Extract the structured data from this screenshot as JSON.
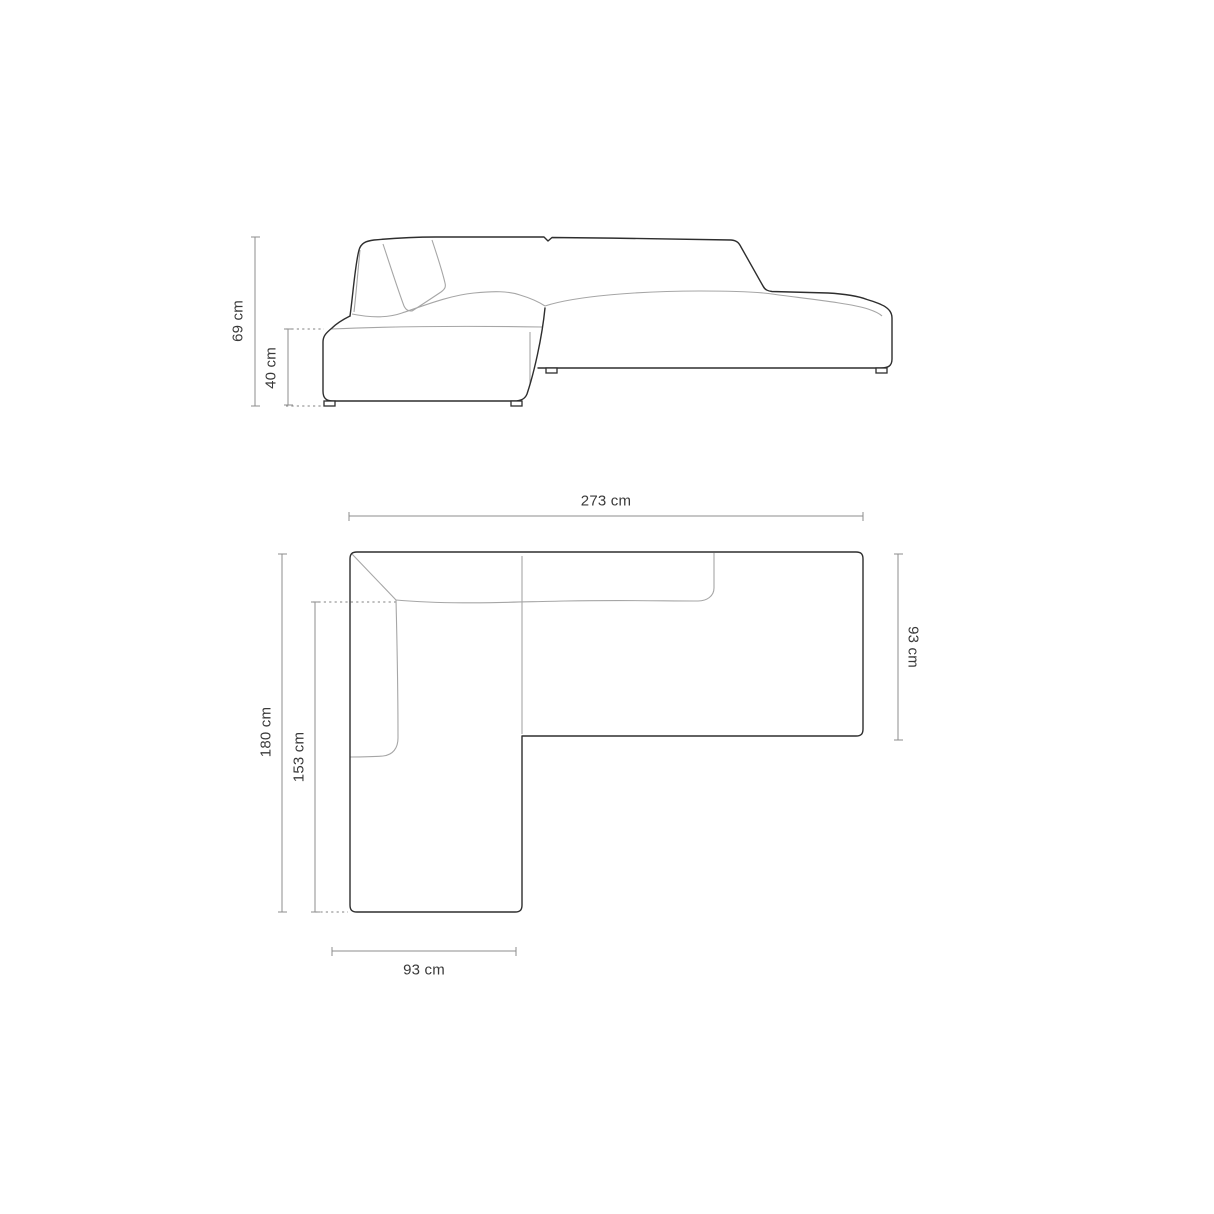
{
  "diagram": {
    "side_view": {
      "dimensions": [
        {
          "id": "total-height",
          "label": "69 cm"
        },
        {
          "id": "seat-height",
          "label": "40 cm"
        }
      ]
    },
    "top_view": {
      "dimensions": [
        {
          "id": "total-width",
          "label": "273 cm"
        },
        {
          "id": "main-section-depth",
          "label": "93 cm"
        },
        {
          "id": "total-depth",
          "label": "180 cm"
        },
        {
          "id": "chaise-inner-length",
          "label": "153 cm"
        },
        {
          "id": "chaise-width",
          "label": "93 cm"
        }
      ]
    },
    "colors": {
      "outline": "#2e2e2e",
      "seam_line": "#a6a6a6",
      "dimension_line": "#8c8c8c",
      "label_text": "#3a3a3a",
      "background": "#ffffff"
    }
  }
}
